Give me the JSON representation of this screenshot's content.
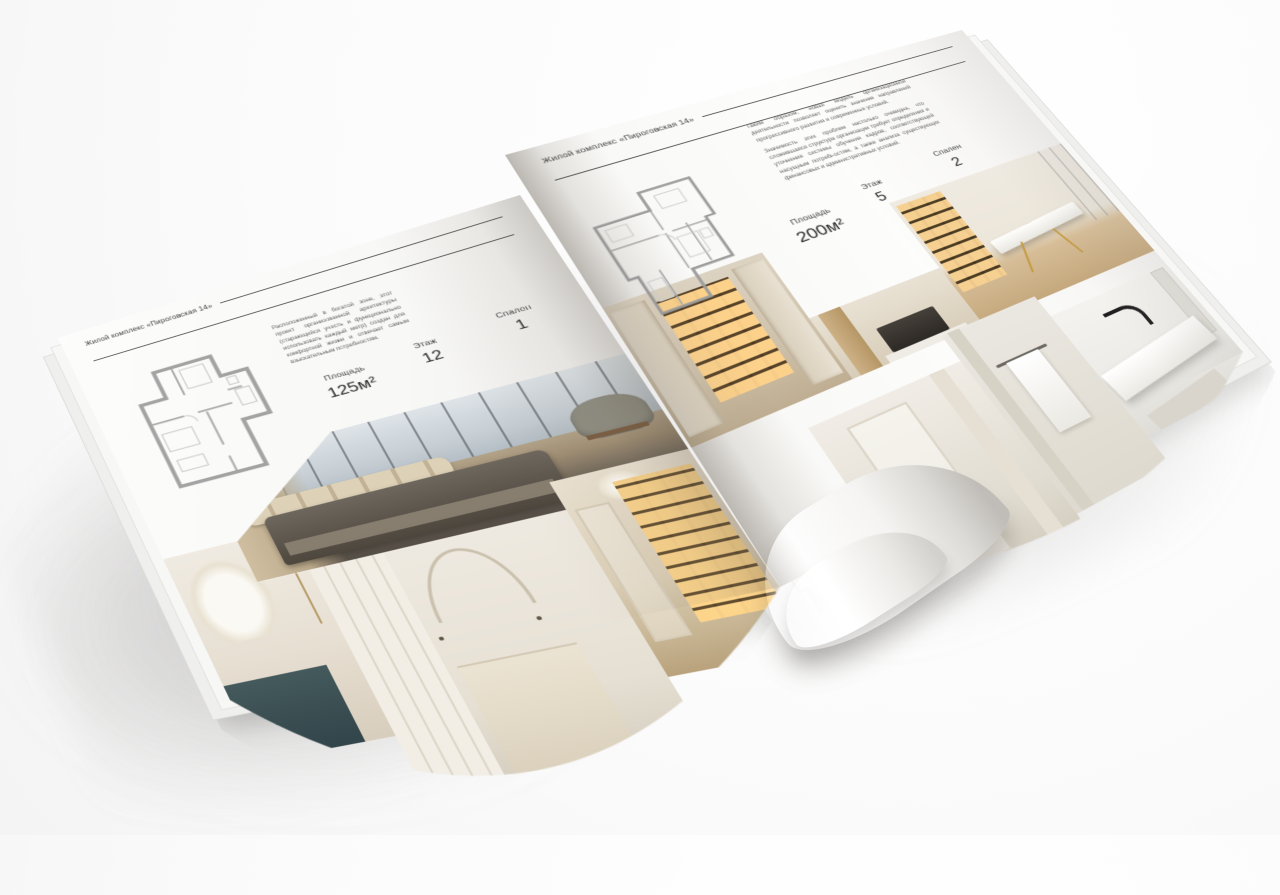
{
  "scene": {
    "object": "open square interior-design brochure mockup on light surface",
    "background_color": "#fbfbfb",
    "accent_text_color": "#3a3a3a"
  },
  "pages": [
    {
      "side": "left",
      "header_title": "Жилой комплекс «Пироговская 14»",
      "paragraphs": [
        "Расположенный в богатой зоне, этот проект организованной архитектуры (старающийся учесть и функционально использовать каждый метр) создан для комфортной жизни и отвечает самым взыскательным потребностям."
      ],
      "specs": [
        {
          "label": "Площадь",
          "value": "125м²"
        },
        {
          "label": "Этаж",
          "value": "12"
        },
        {
          "label": "Спален",
          "value": "1"
        }
      ],
      "floor_plan": "one-bedroom apartment plan drawing",
      "photos": [
        "master bedroom with panoramic city window",
        "nightstand with white flowers on dark teal console",
        "light bedroom with arched decor and wardrobe",
        "hallway with illuminated shelving and chandelier"
      ]
    },
    {
      "side": "right",
      "header_title": "Жилой комплекс «Пироговская 14»",
      "paragraphs": [
        "Таким образом, новая модель организационной деятельности позволяет оценить значение направлений прогрессивного развития и современных условий.",
        "Значимость этих проблем настолько очевидна, что сложившаяся структура организации требует определения и уточнения системы обучения кадров, соответствующей насущным потребностям, а также анализа существующих финансовых и административных условий."
      ],
      "specs": [
        {
          "label": "Площадь",
          "value": "200м²"
        },
        {
          "label": "Этаж",
          "value": "5"
        },
        {
          "label": "Спален",
          "value": "2"
        }
      ],
      "floor_plan": "two-bedroom apartment plan drawing",
      "photos": [
        "walk-in wardrobe with backlit shelves",
        "closet niche with dark appliance",
        "study with white desk on gold legs and glass partition",
        "white hallway with door",
        "bathroom towel rail with white towel",
        "marble washbasin with black tap and mirror"
      ]
    }
  ]
}
